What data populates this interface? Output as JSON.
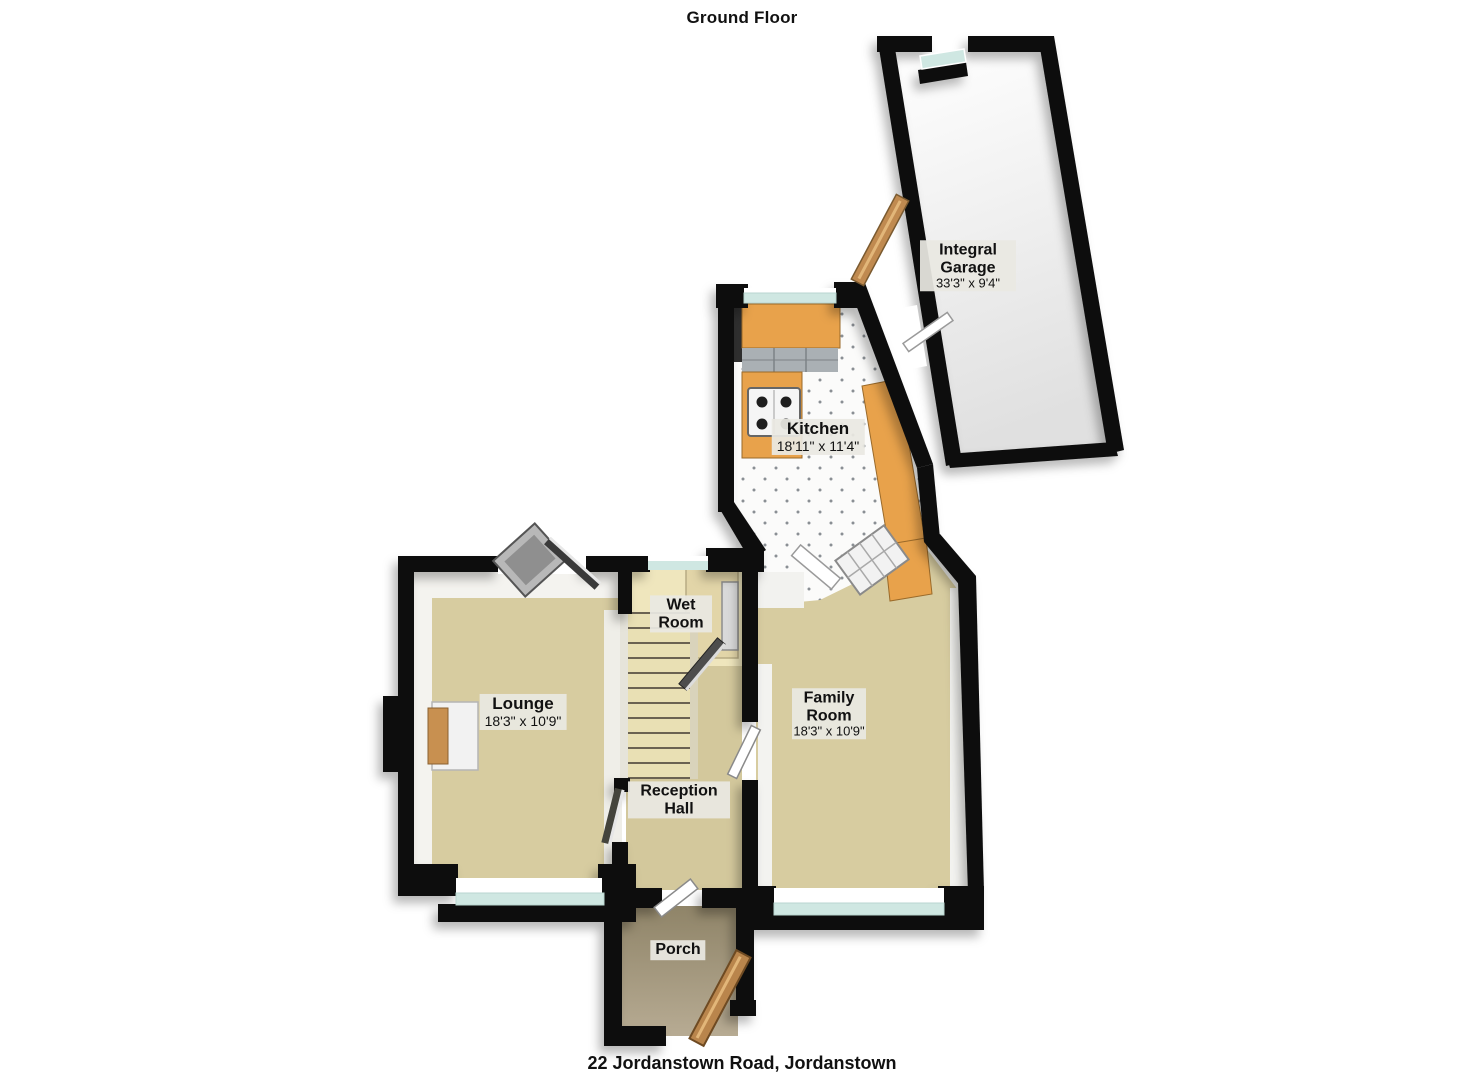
{
  "page": {
    "title": "Ground Floor",
    "footer": "22 Jordanstown Road, Jordanstown"
  },
  "rooms": {
    "integral_garage": {
      "name": "Integral Garage",
      "dims": "33'3\" x 9'4\""
    },
    "kitchen": {
      "name": "Kitchen",
      "dims": "18'11\" x 11'4\""
    },
    "wet_room": {
      "name": "Wet Room"
    },
    "lounge": {
      "name": "Lounge",
      "dims": "18'3\" x 10'9\""
    },
    "family_room": {
      "name": "Family Room",
      "dims": "18'3\" x 10'9\""
    },
    "reception_hall": {
      "name": "Reception Hall"
    },
    "porch": {
      "name": "Porch"
    }
  },
  "colors": {
    "wall": "#0c0c0c",
    "carpet": "#d7cca0",
    "wetroom_floor": "#efe6bd",
    "shower_floor": "#e2d5a8",
    "porch_floor": "#ab9e85",
    "counter": "#e8a24b",
    "glass": "#cfe7e2",
    "stairs": "#e9e0b4",
    "tile_dot": "#8a8f94",
    "wood_door": "#b9854c"
  }
}
